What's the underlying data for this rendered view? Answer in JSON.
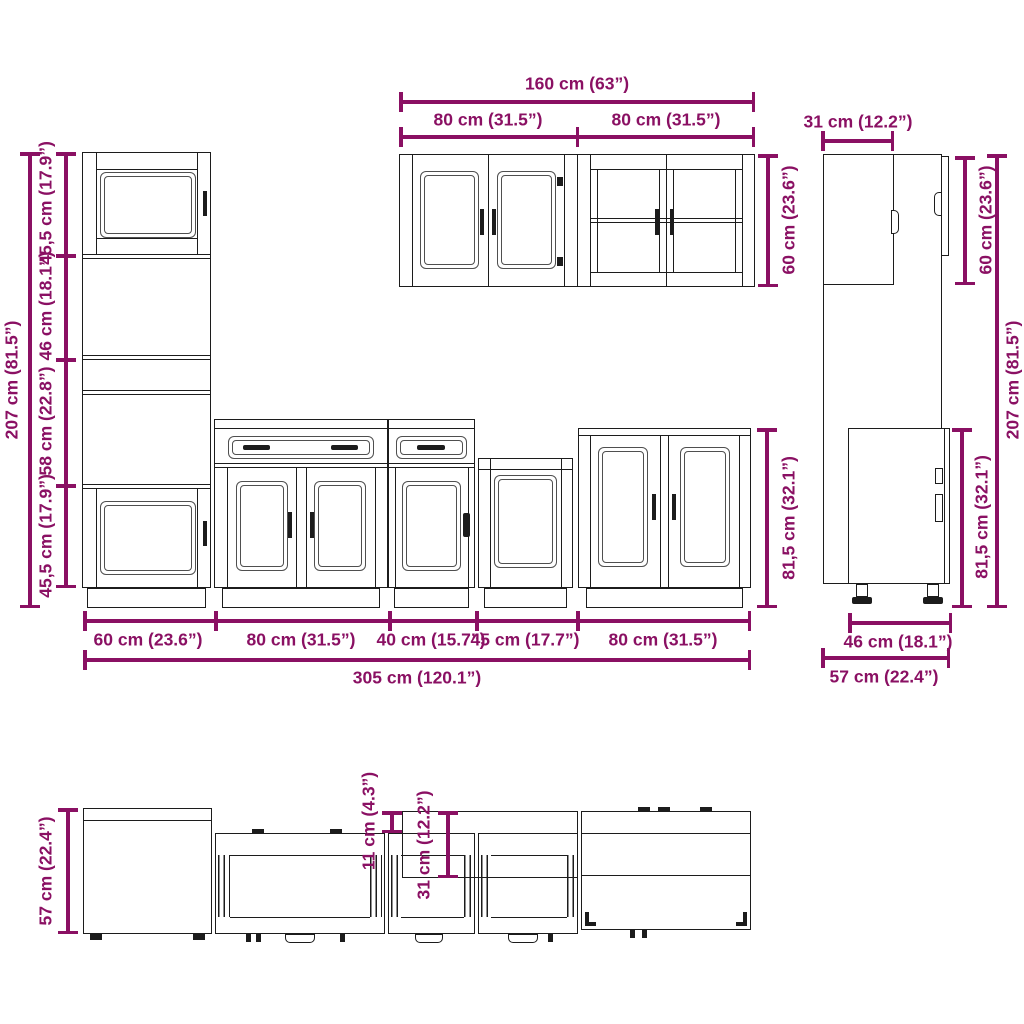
{
  "colors": {
    "dim": "#8a1063",
    "ink": "#1c1c1c",
    "ink2": "#4f4f4f",
    "bg": "#ffffff"
  },
  "diagram": {
    "tall_front": {
      "total_height": "207 cm (81.5”)",
      "seg_top": "45,5 cm (17.9”)",
      "seg_upper": "46 cm (18.1”)",
      "seg_lower": "58 cm (22.8”)",
      "seg_bottom": "45,5 cm (17.9”)"
    },
    "wall_front": {
      "total_width": "160 cm (63”)",
      "left_width": "80 cm (31.5”)",
      "right_width": "80 cm (31.5”)",
      "height": "60 cm (23.6”)"
    },
    "base_front": {
      "height": "81,5 cm (32.1”)",
      "width_tall": "60 cm (23.6”)",
      "width_80a": "80 cm (31.5”)",
      "width_40": "40 cm (15.7”)",
      "width_45": "45 cm (17.7”)",
      "width_80b": "80 cm (31.5”)",
      "total_width": "305 cm (120.1”)"
    },
    "side_view": {
      "wall_depth": "31 cm (12.2”)",
      "wall_height": "60 cm (23.6”)",
      "total_height": "207 cm (81.5”)",
      "base_height": "81,5 cm (32.1”)",
      "base_depth": "46 cm (18.1”)",
      "total_depth": "57 cm (22.4”)"
    },
    "plan_view": {
      "total_depth": "57 cm (22.4”)",
      "front_offset": "11 cm (4.3”)",
      "wall_depth": "31 cm (12.2”)"
    }
  }
}
